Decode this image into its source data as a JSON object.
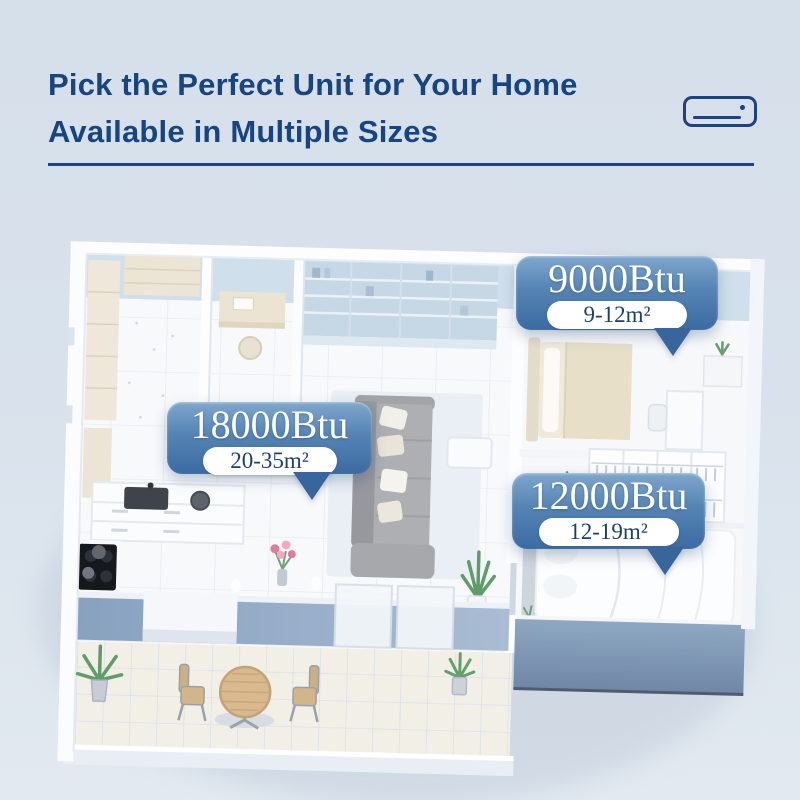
{
  "header": {
    "title_line1": "Pick the Perfect Unit for Your Home",
    "title_line2": "Available in Multiple Sizes"
  },
  "icons": {
    "ac_unit": "air-conditioner-icon"
  },
  "badges": [
    {
      "room": "living-room",
      "btu": "18000Btu",
      "area": "20-35m²"
    },
    {
      "room": "small-bedroom",
      "btu": "9000Btu",
      "area": "9-12m²"
    },
    {
      "room": "medium-bedroom",
      "btu": "12000Btu",
      "area": "12-19m²"
    }
  ],
  "colors": {
    "background": "#d9e2ec",
    "title_text": "#17457f",
    "divider_line": "#1c4480",
    "badge_gradient_top": "#7fa7cd",
    "badge_gradient_bottom": "#3c6ba2",
    "badge_text": "#ffffff",
    "pill_background": "#ffffff",
    "pill_text": "#1e3f6e",
    "wall_exterior_blue": "#8ca6c3",
    "wall_interior_blue": "#cfdfec",
    "floor_white": "#f7f8fa"
  }
}
